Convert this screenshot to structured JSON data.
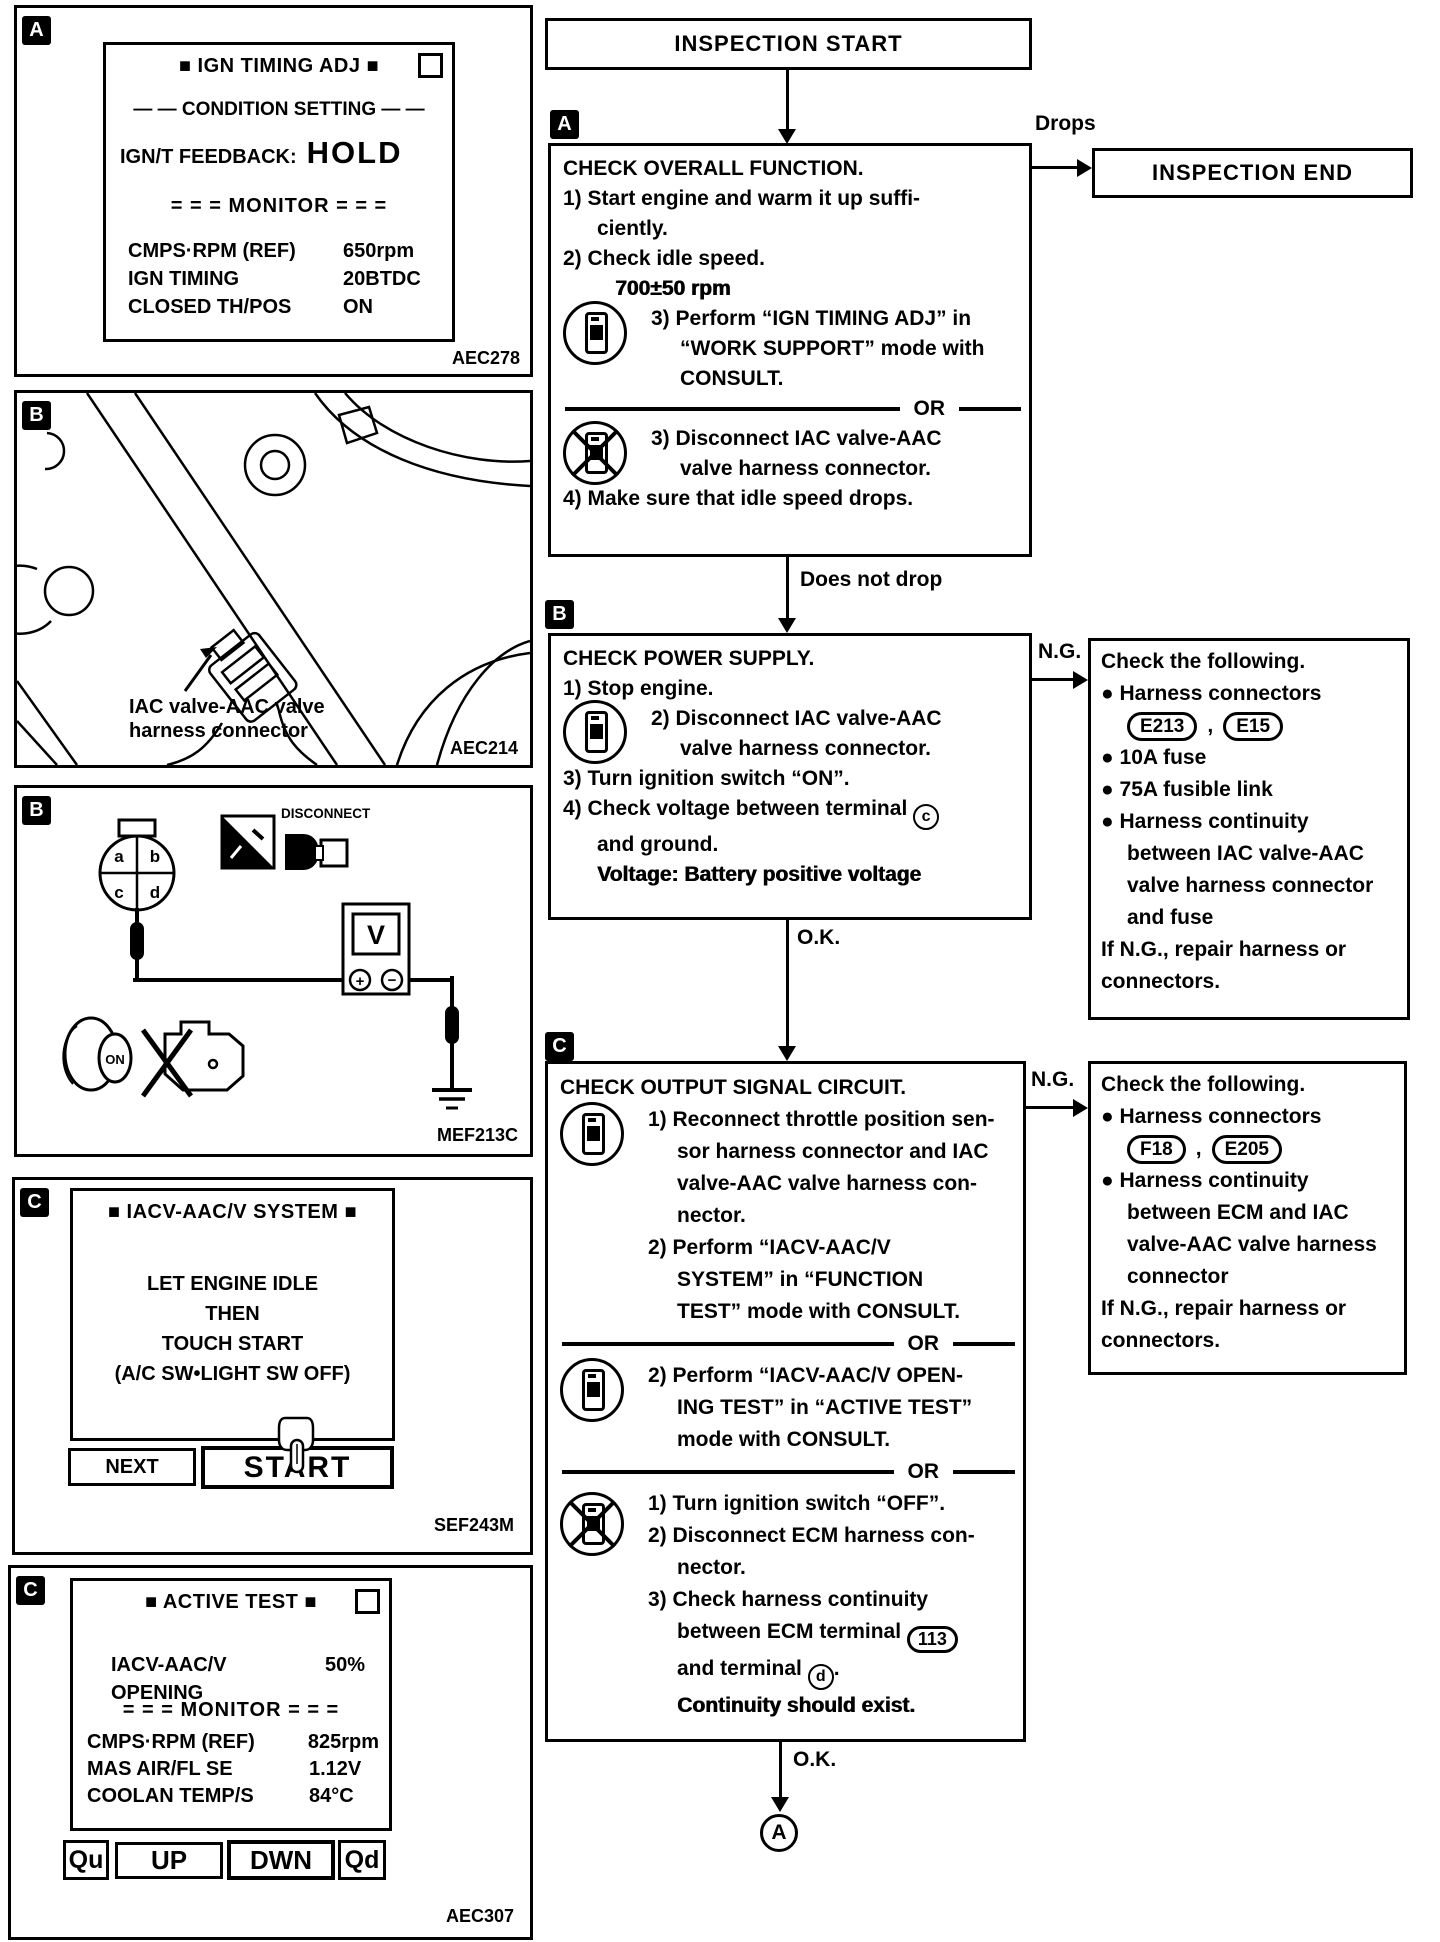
{
  "colors": {
    "ink": "#000000",
    "paper": "#ffffff"
  },
  "figures": {
    "fig_a": {
      "tag": "A",
      "code": "AEC278",
      "screen": {
        "title": "■ IGN TIMING ADJ ■",
        "condition": "— — CONDITION SETTING — —",
        "feedback_label": "IGN/T FEEDBACK:",
        "feedback_value": "HOLD",
        "monitor": "= = = MONITOR = = =",
        "rows": [
          {
            "label": "CMPS·RPM (REF)",
            "value": "650rpm"
          },
          {
            "label": "IGN TIMING",
            "value": "20BTDC"
          },
          {
            "label": "CLOSED TH/POS",
            "value": "ON"
          }
        ]
      }
    },
    "fig_b_photo": {
      "tag": "B",
      "code": "AEC214",
      "callout_line1": "IAC valve-AAC valve",
      "callout_line2": "harness connector"
    },
    "fig_b_wiring": {
      "tag": "B",
      "code": "MEF213C",
      "pin_a": "a",
      "pin_b": "b",
      "pin_c": "c",
      "pin_d": "d",
      "disconnect_label": "DISCONNECT",
      "meter_letter": "V",
      "meter_plus": "+",
      "meter_minus": "−",
      "key_label": "ON"
    },
    "fig_c_system": {
      "tag": "C",
      "code": "SEF243M",
      "title": "■ IACV-AAC/V SYSTEM ■",
      "body": [
        "LET ENGINE IDLE",
        "THEN",
        "TOUCH START",
        "(A/C SW•LIGHT SW OFF)"
      ],
      "next_label": "NEXT",
      "start_label": "START"
    },
    "fig_c_active": {
      "tag": "C",
      "code": "AEC307",
      "title": "■ ACTIVE TEST ■",
      "param_label": "IACV-AAC/V",
      "param_value": "50%",
      "param_label2": "OPENING",
      "monitor": "= = = MONITOR = = =",
      "rows": [
        {
          "label": "CMPS·RPM (REF)",
          "value": "825rpm"
        },
        {
          "label": "MAS AIR/FL SE",
          "value": "1.12V"
        },
        {
          "label": "COOLAN TEMP/S",
          "value": "84°C"
        }
      ],
      "buttons": [
        "Qu",
        "UP",
        "DWN",
        "Qd"
      ]
    }
  },
  "flow": {
    "start": "INSPECTION START",
    "end": "INSPECTION END",
    "drops": "Drops",
    "does_not_drop": "Does not drop",
    "ng1_label": "N.G.",
    "ok1_label": "O.K.",
    "ng2_label": "N.G.",
    "ok2_label": "O.K.",
    "goto_label": "A",
    "box_a": {
      "tag": "A",
      "lines": [
        {
          "t": "CHECK OVERALL FUNCTION.",
          "c": "l0"
        },
        {
          "t": "1) Start engine and warm it up suffi-",
          "c": "l0"
        },
        {
          "t": "ciently.",
          "c": "l1"
        },
        {
          "t": "2) Check idle speed.",
          "c": "l0"
        },
        {
          "t": "700±50 rpm",
          "c": "v em"
        },
        {
          "t": "3) Perform “IGN TIMING ADJ” in",
          "c": "l2"
        },
        {
          "t": "“WORK SUPPORT” mode with",
          "c": "l3"
        },
        {
          "t": "CONSULT.",
          "c": "l3"
        },
        {
          "t": "OR",
          "c": "or"
        },
        {
          "t": "3) Disconnect IAC valve-AAC",
          "c": "l2"
        },
        {
          "t": "valve harness connector.",
          "c": "l3"
        },
        {
          "t": "4) Make sure that idle speed drops.",
          "c": "l0"
        }
      ],
      "icons": [
        {
          "type": "consult",
          "top": 155
        },
        {
          "type": "noconsult",
          "top": 275
        }
      ]
    },
    "box_b": {
      "tag": "B",
      "lines": [
        {
          "t": "CHECK POWER SUPPLY.",
          "c": "l0"
        },
        {
          "t": "1) Stop engine.",
          "c": "l0"
        },
        {
          "t": "2) Disconnect IAC valve-AAC",
          "c": "l2"
        },
        {
          "t": "valve harness connector.",
          "c": "l3"
        },
        {
          "t": "3) Turn ignition switch “ON”.",
          "c": "l0"
        },
        {
          "t": "4) Check voltage between terminal ",
          "c": "l0",
          "circ": "c",
          "circCls": "round"
        },
        {
          "t": "and ground.",
          "c": "l1"
        },
        {
          "t": "Voltage: Battery positive voltage",
          "c": "l1 em"
        }
      ],
      "icons": [
        {
          "type": "consult",
          "top": 64
        }
      ]
    },
    "box_c": {
      "tag": "C",
      "lines": [
        {
          "t": "CHECK OUTPUT SIGNAL CIRCUIT.",
          "c": "l0"
        },
        {
          "t": "1) Reconnect throttle position sen-",
          "c": "l2"
        },
        {
          "t": "sor harness connector and IAC",
          "c": "l3"
        },
        {
          "t": "valve-AAC valve harness con-",
          "c": "l3"
        },
        {
          "t": "nector.",
          "c": "l3"
        },
        {
          "t": "2) Perform “IACV-AAC/V",
          "c": "l2"
        },
        {
          "t": "SYSTEM” in “FUNCTION",
          "c": "l3"
        },
        {
          "t": "TEST” mode with CONSULT.",
          "c": "l3"
        },
        {
          "t": "OR",
          "c": "or"
        },
        {
          "t": "2) Perform “IACV-AAC/V OPEN-",
          "c": "l2"
        },
        {
          "t": "ING TEST” in “ACTIVE TEST”",
          "c": "l3"
        },
        {
          "t": "mode with CONSULT.",
          "c": "l3"
        },
        {
          "t": "OR",
          "c": "or"
        },
        {
          "t": "1) Turn ignition switch “OFF”.",
          "c": "l2"
        },
        {
          "t": "2) Disconnect ECM harness con-",
          "c": "l2"
        },
        {
          "t": "nector.",
          "c": "l3"
        },
        {
          "t": "3) Check harness continuity",
          "c": "l2"
        },
        {
          "t": "between ECM terminal ",
          "c": "l3",
          "circ": "113",
          "circCls": "oval"
        },
        {
          "t": "and terminal ",
          "c": "l3",
          "circ": "d",
          "circCls": "round",
          "t2": "."
        },
        {
          "t": "Continuity should exist.",
          "c": "l3 em"
        }
      ],
      "icons": [
        {
          "type": "consult",
          "top": 38
        },
        {
          "type": "consult",
          "top": 294
        },
        {
          "type": "noconsult",
          "top": 428
        }
      ]
    },
    "ng_box_1": {
      "lines_pre": [
        {
          "t": "Check the following.",
          "c": "l0"
        },
        {
          "t": "● Harness connectors",
          "c": "l0"
        }
      ],
      "connectors": [
        "E213",
        "E15"
      ],
      "separator": ",",
      "lines_post": [
        {
          "t": "● 10A fuse",
          "c": "l0"
        },
        {
          "t": "● 75A fusible link",
          "c": "l0"
        },
        {
          "t": "● Harness continuity",
          "c": "l0"
        },
        {
          "t": "between IAC valve-AAC",
          "c": "li"
        },
        {
          "t": "valve harness connector",
          "c": "li"
        },
        {
          "t": "and fuse",
          "c": "li"
        },
        {
          "t": "If N.G., repair harness or",
          "c": "l0"
        },
        {
          "t": "connectors.",
          "c": "l0"
        }
      ]
    },
    "ng_box_2": {
      "lines_pre": [
        {
          "t": "Check the following.",
          "c": "l0"
        },
        {
          "t": "● Harness connectors",
          "c": "l0"
        }
      ],
      "connectors": [
        "F18",
        "E205"
      ],
      "separator": ",",
      "lines_post": [
        {
          "t": "● Harness continuity",
          "c": "l0"
        },
        {
          "t": "between ECM and IAC",
          "c": "li"
        },
        {
          "t": "valve-AAC valve harness",
          "c": "li"
        },
        {
          "t": "connector",
          "c": "li"
        },
        {
          "t": "If N.G., repair harness or",
          "c": "l0"
        },
        {
          "t": "connectors.",
          "c": "l0"
        }
      ]
    }
  }
}
